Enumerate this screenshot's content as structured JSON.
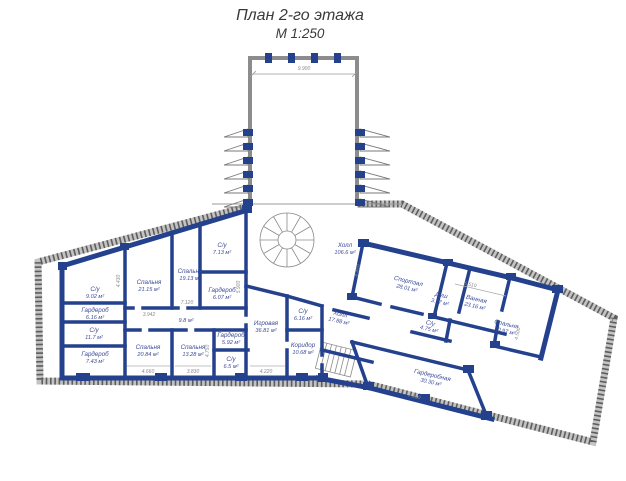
{
  "title": {
    "line1": "План 2-го этажа",
    "line2": "М 1:250"
  },
  "rooms": [
    {
      "name": "С/у",
      "area": "9.02 м²"
    },
    {
      "name": "Гардероб",
      "area": "6.16 м²"
    },
    {
      "name": "С/у",
      "area": "11.7 м²"
    },
    {
      "name": "Гардероб",
      "area": "7.43 м²"
    },
    {
      "name": "Спальня",
      "area": "21.15 м²"
    },
    {
      "name": "Спальня",
      "area": "19.13 м²"
    },
    {
      "name": "С/у",
      "area": "7.13 м²"
    },
    {
      "name": "Гардероб",
      "area": "6.07 м²"
    },
    {
      "name": "Спальня",
      "area": "20.84 м²"
    },
    {
      "name": "Спальня",
      "area": "13.28 м²"
    },
    {
      "name": "Гардероб",
      "area": "5.92 м²"
    },
    {
      "name": "С/у",
      "area": "6.5 м²"
    },
    {
      "name": "",
      "area": "9.8 м²"
    },
    {
      "name": "Игровая",
      "area": "36.81 м²"
    },
    {
      "name": "С/у",
      "area": "6.16 м²"
    },
    {
      "name": "Коридор",
      "area": "10.68 м²"
    },
    {
      "name": "Холл",
      "area": "17.88 м²"
    },
    {
      "name": "Холл",
      "area": "106.6 м²"
    },
    {
      "name": "Спортзал",
      "area": "28.01 м²"
    },
    {
      "name": "Душ",
      "area": "3.77 м²"
    },
    {
      "name": "Ванная",
      "area": "23.16 м²"
    },
    {
      "name": "С/у",
      "area": "4.75 м²"
    },
    {
      "name": "Спальня",
      "area": "50.97 м²"
    },
    {
      "name": "Гардеробная",
      "area": "30.30 м²"
    }
  ],
  "dimensions": [
    "9.900",
    "4.430",
    "3.942",
    "7.120",
    "5.900",
    "4.660",
    "3.830",
    "4.750",
    "4.220",
    "4.450",
    "5.510",
    "4.500",
    "7.830"
  ],
  "colors": {
    "wall_blue": "#24418e",
    "boundary_gray": "#8c8c8c",
    "label_blue": "#3c4a96",
    "dimension_gray": "#8a8a8a"
  }
}
